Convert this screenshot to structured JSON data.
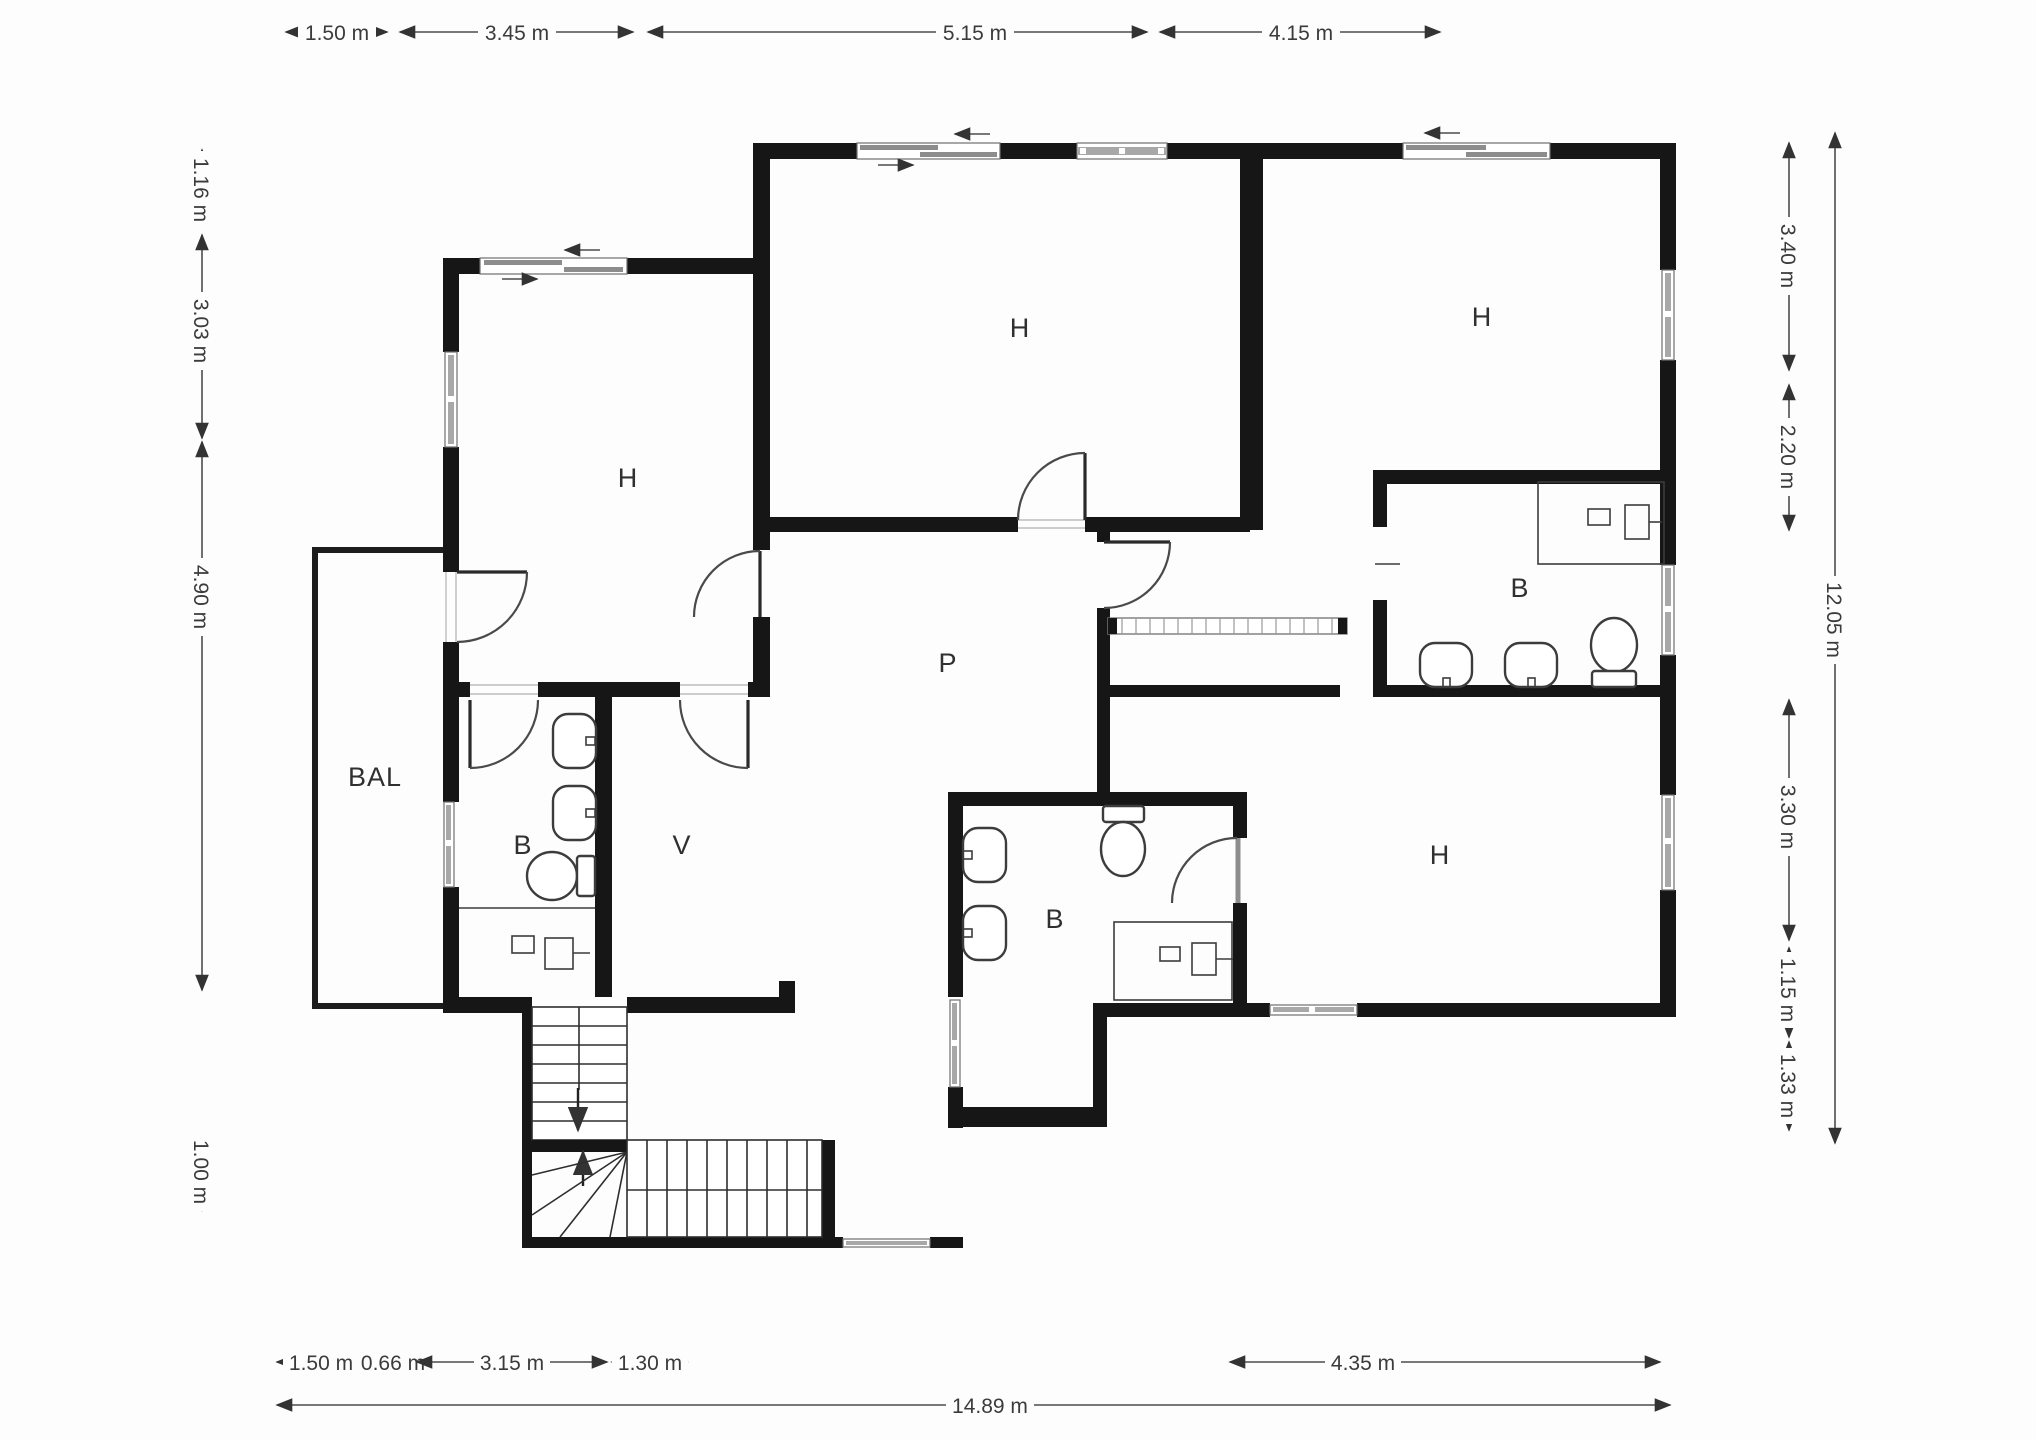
{
  "plan": {
    "title": "floor-plan",
    "rooms": [
      {
        "id": "room-h-top-left",
        "label": "H"
      },
      {
        "id": "room-h-top-center",
        "label": "H"
      },
      {
        "id": "room-h-top-right",
        "label": "H"
      },
      {
        "id": "room-h-bottom-right",
        "label": "H"
      },
      {
        "id": "bath-top-right",
        "label": "B"
      },
      {
        "id": "bath-bottom-left",
        "label": "B"
      },
      {
        "id": "bath-bottom-center",
        "label": "B"
      },
      {
        "id": "hall-p",
        "label": "P"
      },
      {
        "id": "dressing-v",
        "label": "V"
      },
      {
        "id": "balcony",
        "label": "BAL"
      }
    ],
    "dims": {
      "top": [
        {
          "label": "1.50 m"
        },
        {
          "label": "3.45 m"
        },
        {
          "label": "5.15 m"
        },
        {
          "label": "4.15 m"
        }
      ],
      "left": [
        {
          "label": "1.16 m"
        },
        {
          "label": "3.03 m"
        },
        {
          "label": "4.90 m"
        },
        {
          "label": "1.00 m"
        }
      ],
      "right_inner": [
        {
          "label": "3.40 m"
        },
        {
          "label": "2.20 m"
        },
        {
          "label": "3.30 m"
        },
        {
          "label": "1.15 m"
        },
        {
          "label": "1.33 m"
        }
      ],
      "right_outer": {
        "label": "12.05 m"
      },
      "bottom": [
        {
          "label": "1.50 m"
        },
        {
          "label": "0.66 m"
        },
        {
          "label": "3.15 m"
        },
        {
          "label": "1.30 m"
        },
        {
          "label": "4.35 m"
        }
      ],
      "bottom_total": {
        "label": "14.89 m"
      }
    },
    "fixtures": [
      {
        "name": "shower-icon"
      },
      {
        "name": "washbasin-icon"
      },
      {
        "name": "toilet-icon"
      },
      {
        "name": "stairs-icon"
      },
      {
        "name": "closet-icon"
      }
    ],
    "colors": {
      "wall": "#161616",
      "window": "#a8a8a8",
      "dimension_line": "#4d4d4d",
      "text": "#3b3b3b",
      "background": "#fdfdfd"
    }
  }
}
